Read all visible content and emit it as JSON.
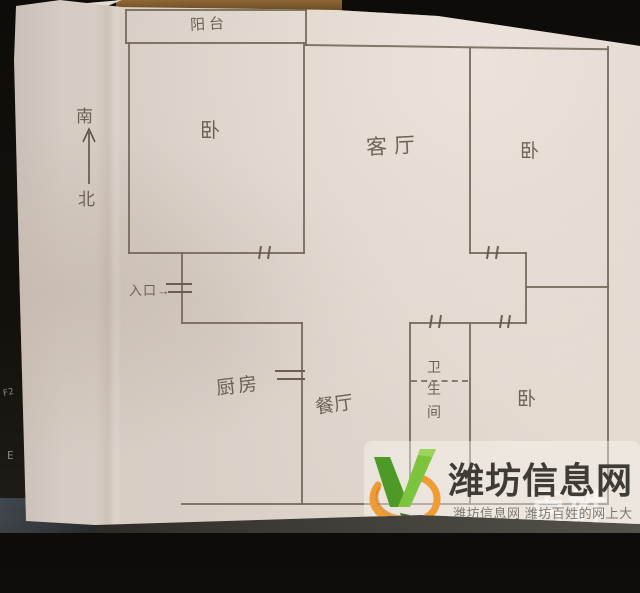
{
  "scene": {
    "description": "photo of a hand-drawn apartment floor plan in pencil on beige paper",
    "paper_color": "#dbd1c8",
    "pencil_color": "#766a5c",
    "background_color": "#14110d"
  },
  "compass": {
    "south": "南",
    "north": "北"
  },
  "entrance": {
    "label": "入口→"
  },
  "rooms": {
    "balcony": "阳台",
    "bedroom_nw": "卧",
    "living": "客厅",
    "bedroom_ne": "卧",
    "kitchen": "厨房",
    "dining": "餐厅",
    "bathroom": "卫生间",
    "bedroom_se": "卧"
  },
  "watermark": {
    "title": "潍坊信息网",
    "tagline": "潍坊信息网 潍坊百姓的网上大集",
    "ghost_text": "百姓网",
    "title_color": "#3f3b35",
    "tagline_color": "#7d786f",
    "logo_green": "#72bc3a",
    "logo_green_dark": "#4d9a26",
    "logo_orange": "#f09c34"
  },
  "background_marks": {
    "mark1": "F2",
    "mark2": "E"
  }
}
